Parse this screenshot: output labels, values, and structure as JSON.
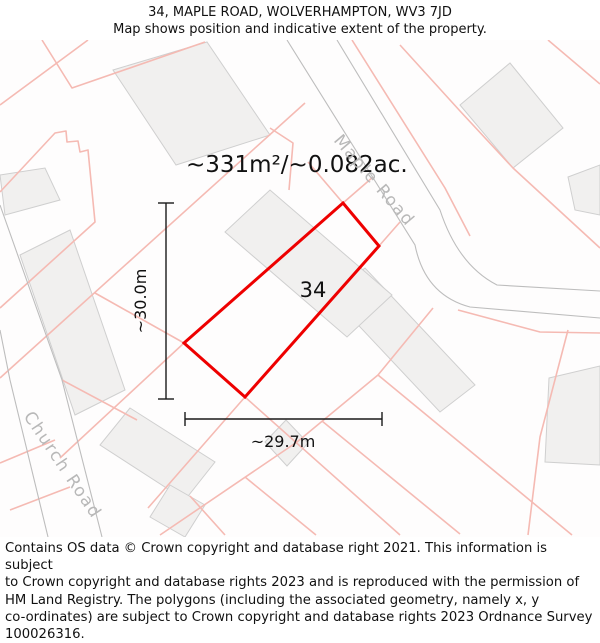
{
  "header": {
    "title": "34, MAPLE ROAD, WOLVERHAMPTON, WV3 7JD",
    "subtitle": "Map shows position and indicative extent of the property."
  },
  "map": {
    "area_label": "~331m²/~0.082ac.",
    "plot_number": "34",
    "height_label": "~30.0m",
    "width_label": "~29.7m",
    "roads": [
      {
        "name": "Maple Road"
      },
      {
        "name": "Church Road"
      }
    ],
    "colors": {
      "plot_outline": "#ee0000",
      "parcel_line": "#f5bab3",
      "road_edge": "#bdbdbd",
      "building_fill": "#f1f0ef",
      "building_stroke": "#cfcfcf",
      "road_label": "#b8b8b8",
      "dimension": "#1a1a1a"
    }
  },
  "footer": {
    "lines": [
      "Contains OS data © Crown copyright and database right 2021. This information is subject",
      "to Crown copyright and database rights 2023 and is reproduced with the permission of",
      "HM Land Registry. The polygons (including the associated geometry, namely x, y",
      "co-ordinates) are subject to Crown copyright and database rights 2023 Ordnance Survey",
      "100026316."
    ]
  }
}
